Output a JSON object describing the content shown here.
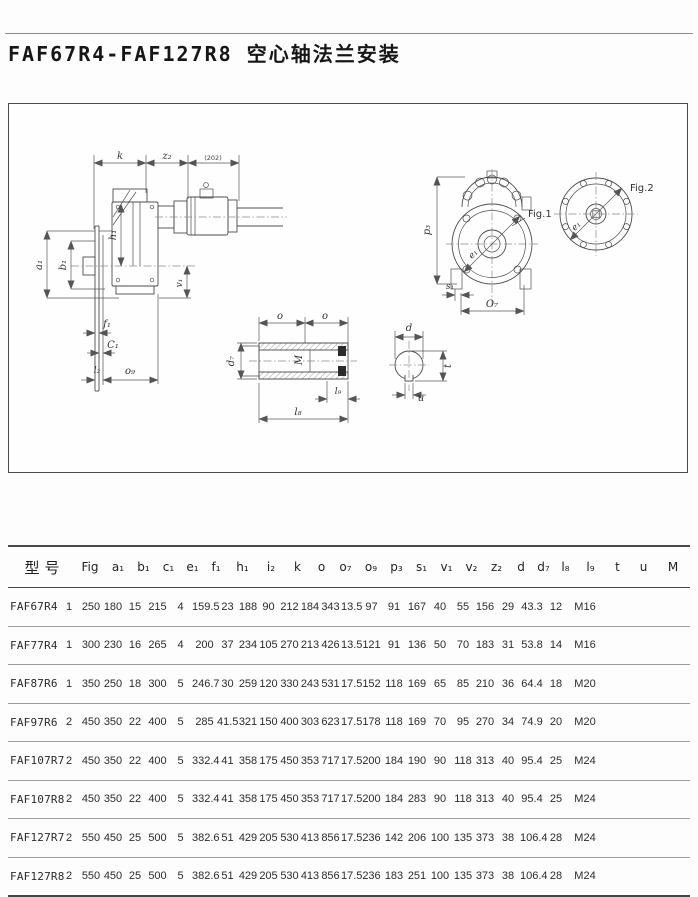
{
  "page": {
    "title": "FAF67R4-FAF127R8 空心轴法兰安装"
  },
  "drawing": {
    "labels": {
      "k": "k",
      "z2": "z₂",
      "motor_note": "(202)",
      "a1": "a₁",
      "b1": "b₁",
      "h1": "h₁",
      "v1": "v₁",
      "f1": "f₁",
      "c1": "C₁",
      "l2": "l₂",
      "o9": "o₉",
      "p3": "p₃",
      "e1": "e₁",
      "s1": "s₁",
      "o7": "O₇",
      "fig1": "Fig.1",
      "fig2": "Fig.2",
      "o_left": "o",
      "o_right": "o",
      "d7": "d₇",
      "m_thread": "M",
      "l9": "l₉",
      "l8": "l₈",
      "d": "d",
      "t": "t",
      "u": "u"
    }
  },
  "table": {
    "model_header": "型号",
    "fig_header": "Fig",
    "dim_headers": [
      "a₁",
      "b₁",
      "c₁",
      "e₁",
      "f₁",
      "h₁",
      "i₂",
      "k",
      "o",
      "o₇",
      "o₉",
      "p₃",
      "s₁",
      "v₁",
      "v₂",
      "z₂",
      "d",
      "d₇",
      "l₈",
      "l₉",
      "t",
      "u",
      "M"
    ],
    "rows": [
      {
        "model": "FAF67R4",
        "fig": "1",
        "values": [
          "250",
          "180",
          "15",
          "215",
          "4",
          "159.5",
          "23",
          "188",
          "90",
          "212",
          "184",
          "343",
          "13.5",
          "97",
          "91",
          "167",
          "40",
          "55",
          "156",
          "29",
          "43.3",
          "12",
          "M16"
        ]
      },
      {
        "model": "FAF77R4",
        "fig": "1",
        "values": [
          "300",
          "230",
          "16",
          "265",
          "4",
          "200",
          "37",
          "234",
          "105",
          "270",
          "213",
          "426",
          "13.5",
          "121",
          "91",
          "136",
          "50",
          "70",
          "183",
          "31",
          "53.8",
          "14",
          "M16"
        ]
      },
      {
        "model": "FAF87R6",
        "fig": "1",
        "values": [
          "350",
          "250",
          "18",
          "300",
          "5",
          "246.7",
          "30",
          "259",
          "120",
          "330",
          "243",
          "531",
          "17.5",
          "152",
          "118",
          "169",
          "65",
          "85",
          "210",
          "36",
          "64.4",
          "18",
          "M20"
        ]
      },
      {
        "model": "FAF97R6",
        "fig": "2",
        "values": [
          "450",
          "350",
          "22",
          "400",
          "5",
          "285",
          "41.5",
          "321",
          "150",
          "400",
          "303",
          "623",
          "17.5",
          "178",
          "118",
          "169",
          "70",
          "95",
          "270",
          "34",
          "74.9",
          "20",
          "M20"
        ]
      },
      {
        "model": "FAF107R7",
        "fig": "2",
        "values": [
          "450",
          "350",
          "22",
          "400",
          "5",
          "332.4",
          "41",
          "358",
          "175",
          "450",
          "353",
          "717",
          "17.5",
          "200",
          "184",
          "190",
          "90",
          "118",
          "313",
          "40",
          "95.4",
          "25",
          "M24"
        ]
      },
      {
        "model": "FAF107R8",
        "fig": "2",
        "values": [
          "450",
          "350",
          "22",
          "400",
          "5",
          "332.4",
          "41",
          "358",
          "175",
          "450",
          "353",
          "717",
          "17.5",
          "200",
          "184",
          "283",
          "90",
          "118",
          "313",
          "40",
          "95.4",
          "25",
          "M24"
        ]
      },
      {
        "model": "FAF127R7",
        "fig": "2",
        "values": [
          "550",
          "450",
          "25",
          "500",
          "5",
          "382.6",
          "51",
          "429",
          "205",
          "530",
          "413",
          "856",
          "17.5",
          "236",
          "142",
          "206",
          "100",
          "135",
          "373",
          "38",
          "106.4",
          "28",
          "M24"
        ]
      },
      {
        "model": "FAF127R8",
        "fig": "2",
        "values": [
          "550",
          "450",
          "25",
          "500",
          "5",
          "382.6",
          "51",
          "429",
          "205",
          "530",
          "413",
          "856",
          "17.5",
          "236",
          "183",
          "251",
          "100",
          "135",
          "373",
          "38",
          "106.4",
          "28",
          "M24"
        ]
      }
    ]
  }
}
